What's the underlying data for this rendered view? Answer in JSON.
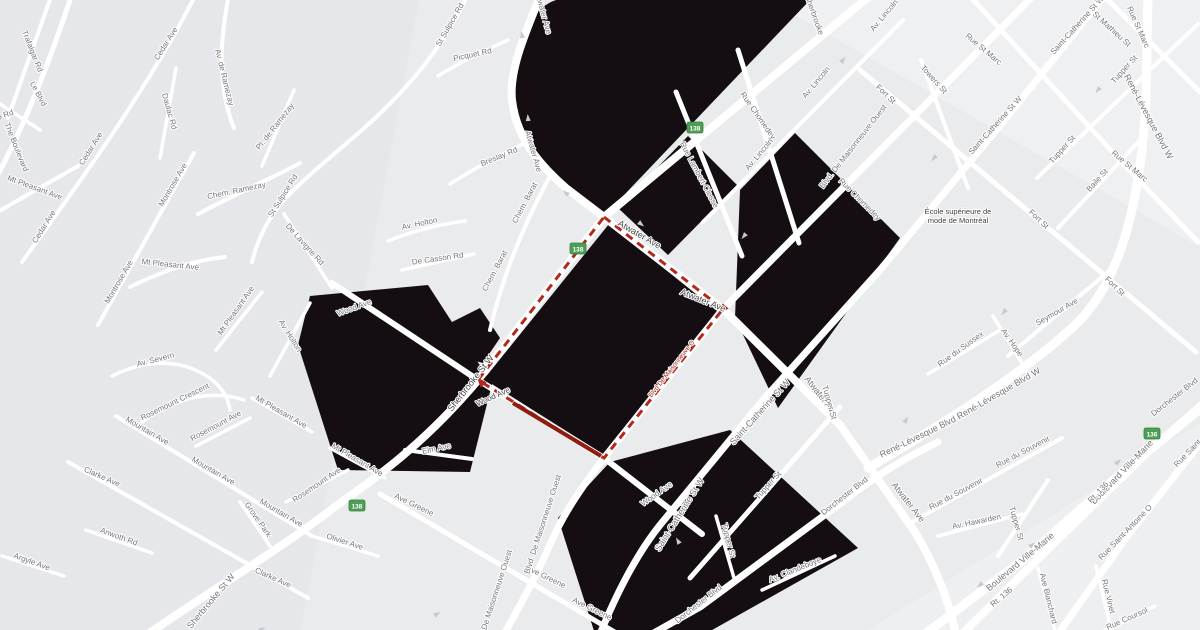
{
  "map": {
    "colors": {
      "background": "#eaebed",
      "tint_west": "#e2e3e7",
      "tint_light": "#f2f3f5",
      "street": "#ffffff",
      "black_area": "#140d12",
      "route_dash": "#b5271b",
      "route_solid": "#8f1b12",
      "shield_fill": "#4d9f55",
      "shield_border": "#3c7f43",
      "label": "#75767a",
      "label_dark": "#46474a",
      "arrow": "#c7c9ce"
    },
    "black_polygons": [
      "M556,0 L810,0 L604,216 C578,197 556,183 541,167 C519,144 511,114 512,84 C513,40 532,8 556,0 Z",
      "M618,208 L688,136 L737,185 L668,255 Z",
      "M740,190 L795,133 L900,238 L778,408 L735,318 Z",
      "M609,224 L717,311 L604,455 L484,379 Z",
      "M452,322 L480,308 L500,338 L483,363 L456,356 Z",
      "M310,296 L428,285 L492,384 L470,472 L338,470 L298,345 Z",
      "M610,462 L730,430 L858,548 L705,634 L595,634 L558,518 Z"
    ],
    "streets": [
      {
        "d": "M541,-6 C523,38 509,72 512,100 C516,134 534,160 566,188 L604,217 L723,309 L840,425 L915,532 C935,565 948,598 956,634",
        "w": 8
      },
      {
        "d": "M872,-6 L604,217 L478,380 C430,437 385,472 340,503 C282,548 230,578 148,634",
        "w": 8
      },
      {
        "d": "M1035,-6 L723,309 L604,458 C578,492 561,518 549,547 C535,578 520,606 504,634",
        "w": 7
      },
      {
        "d": "M1106,-6 L998,128 L880,270 L763,400 L660,525 C640,550 620,585 600,634",
        "w": 7
      },
      {
        "d": "M332,283 L478,380 L604,458 L702,534",
        "w": 6
      },
      {
        "d": "M868,468 C950,420 1020,375 1072,328 C1118,287 1140,210 1146,100 L1148,-6",
        "w": 9
      },
      {
        "d": "M652,634 L700,607 L845,500 C880,473 905,458 938,442",
        "w": 7
      },
      {
        "d": "M925,634 L1023,560 L1125,470 L1205,405",
        "w": 9
      },
      {
        "d": "M962,634 L1052,545 L1148,452 L1205,402",
        "w": 8
      },
      {
        "d": "M1198,446 L1128,535 L1058,634",
        "w": 7
      },
      {
        "d": "M968,-6 L1128,169 L1198,242",
        "w": 5
      },
      {
        "d": "M860,70 L1196,352",
        "w": 5
      },
      {
        "d": "M1102,-6 L1200,92",
        "w": 5
      },
      {
        "d": "M921,60 L968,188",
        "w": 4
      },
      {
        "d": "M676,92 L742,256",
        "w": 5
      },
      {
        "d": "M738,50 L799,243",
        "w": 5
      },
      {
        "d": "M703,222 L903,20",
        "w": 4
      },
      {
        "d": "M1037,178 L1198,24",
        "w": 4
      },
      {
        "d": "M1058,228 L1143,137",
        "w": 4
      },
      {
        "d": "M690,578 L840,407",
        "w": 5
      },
      {
        "d": "M998,556 L1048,480",
        "w": 4
      },
      {
        "d": "M1008,356 L1108,272",
        "w": 4
      },
      {
        "d": "M993,316 L1031,378",
        "w": 3.5
      },
      {
        "d": "M928,374 L1000,330",
        "w": 3.5
      },
      {
        "d": "M912,522 L1062,438",
        "w": 4
      },
      {
        "d": "M938,536 L1022,514",
        "w": 3.5
      },
      {
        "d": "M762,590 L835,556",
        "w": 3.5
      },
      {
        "d": "M1096,566 L1112,634",
        "w": 3.5
      },
      {
        "d": "M1038,568 L1056,634",
        "w": 3.5
      },
      {
        "d": "M1098,634 L1155,606",
        "w": 3.5
      },
      {
        "d": "M716,516 L734,578",
        "w": 3.5
      },
      {
        "d": "M380,494 L618,634",
        "w": 5
      },
      {
        "d": "M405,450 L472,459",
        "w": 4
      },
      {
        "d": "M72,-6 C45,75 22,130 -6,182",
        "w": 5
      },
      {
        "d": "M52,-6 L8,118",
        "w": 4
      },
      {
        "d": "M196,-6 C150,85 85,175 22,262",
        "w": 4
      },
      {
        "d": "M229,-6 C219,45 218,88 234,128",
        "w": 4
      },
      {
        "d": "M198,214 C240,192 272,178 300,163",
        "w": 4
      },
      {
        "d": "M262,166 L294,90",
        "w": 3.5
      },
      {
        "d": "M176,68 L160,158",
        "w": 3.5
      },
      {
        "d": "M468,-6 C442,50 405,92 362,130 C330,158 302,180 284,200 C268,218 258,238 252,262",
        "w": 4
      },
      {
        "d": "M284,214 L332,288",
        "w": 3.5
      },
      {
        "d": "M508,40 C482,52 460,62 438,76",
        "w": 3.5
      },
      {
        "d": "M532,140 C505,152 478,166 450,184",
        "w": 3.5
      },
      {
        "d": "M549,178 C522,228 502,278 490,330",
        "w": 4
      },
      {
        "d": "M388,241 C415,230 442,224 465,221",
        "w": 3.5
      },
      {
        "d": "M270,376 L310,303",
        "w": 3.5
      },
      {
        "d": "M402,270 L474,254",
        "w": 3.5
      },
      {
        "d": "M112,376 C148,358 180,360 205,375 C220,384 228,396 230,410",
        "w": 3.5
      },
      {
        "d": "M194,153 L98,325",
        "w": 4
      },
      {
        "d": "M-6,214 L78,166",
        "w": 4
      },
      {
        "d": "M130,287 C165,270 195,260 225,257",
        "w": 4
      },
      {
        "d": "M216,350 L262,292",
        "w": 3.5
      },
      {
        "d": "M252,398 L312,432",
        "w": 3.5
      },
      {
        "d": "M330,448 L385,478",
        "w": 3.5
      },
      {
        "d": "M142,422 C178,396 212,390 244,400",
        "w": 3.5
      },
      {
        "d": "M196,446 L250,418",
        "w": 3.5
      },
      {
        "d": "M286,502 L348,470",
        "w": 3.5
      },
      {
        "d": "M116,416 L312,536",
        "w": 4
      },
      {
        "d": "M68,462 L308,598",
        "w": 4
      },
      {
        "d": "M86,530 L152,553",
        "w": 3.5
      },
      {
        "d": "M2,556 L64,576",
        "w": 3.5
      },
      {
        "d": "M240,502 L270,546",
        "w": 3.5
      },
      {
        "d": "M312,536 L378,556",
        "w": 3.5
      },
      {
        "d": "M-6,100 L40,130",
        "w": 3.5
      }
    ],
    "route": {
      "loop_points": "604,217 723,309 604,458 478,380 604,217",
      "solid_segment": "M513,403 L601,456",
      "arrowheads": [
        {
          "x": 723,
          "y": 309,
          "rot": 130
        },
        {
          "x": 481,
          "y": 382,
          "rot": 228
        }
      ],
      "street_label": {
        "text": "Blvd De Maisonneuve O",
        "x": 673,
        "y": 370,
        "angle": -52
      }
    },
    "shields": [
      {
        "label": "138",
        "x": 695,
        "y": 128
      },
      {
        "label": "138",
        "x": 578,
        "y": 249
      },
      {
        "label": "138",
        "x": 357,
        "y": 506
      },
      {
        "label": "136",
        "x": 1152,
        "y": 434
      }
    ],
    "poi": {
      "lines": [
        "École supérieure de",
        "mode de Montréal"
      ],
      "x": 958,
      "y": 214
    },
    "street_labels": [
      {
        "t": "Trafalgar Rd",
        "x": 30,
        "y": 52,
        "a": 68
      },
      {
        "t": "Le Blvd",
        "x": 36,
        "y": 95,
        "a": 62
      },
      {
        "t": "The Boulevard",
        "x": 14,
        "y": 148,
        "a": 68
      },
      {
        "t": "eo Rd",
        "x": 4,
        "y": 118,
        "a": -20
      },
      {
        "t": "Cedar Ave",
        "x": 168,
        "y": 45,
        "a": -58
      },
      {
        "t": "Cedar Ave",
        "x": 93,
        "y": 150,
        "a": -58
      },
      {
        "t": "Cedar Ave",
        "x": 46,
        "y": 228,
        "a": -58
      },
      {
        "t": "Av. de Ramezay",
        "x": 222,
        "y": 78,
        "a": 76
      },
      {
        "t": "Daulac Rd",
        "x": 167,
        "y": 112,
        "a": 74
      },
      {
        "t": "Pl. de Ramezay",
        "x": 277,
        "y": 128,
        "a": -52
      },
      {
        "t": "Chem. Ramezay",
        "x": 237,
        "y": 193,
        "a": -12
      },
      {
        "t": "St Sulpice Rd",
        "x": 452,
        "y": 26,
        "a": -60
      },
      {
        "t": "St Sulpice Rd",
        "x": 285,
        "y": 197,
        "a": -58
      },
      {
        "t": "Montrose Ave",
        "x": 175,
        "y": 186,
        "a": -60
      },
      {
        "t": "Montrose Ave",
        "x": 121,
        "y": 283,
        "a": -60
      },
      {
        "t": "Mt Pleasant Ave",
        "x": 34,
        "y": 190,
        "a": 20
      },
      {
        "t": "Mt Pleasant Ave",
        "x": 170,
        "y": 267,
        "a": 6
      },
      {
        "t": "Mt Pleasant Ave",
        "x": 238,
        "y": 312,
        "a": -55
      },
      {
        "t": "Mt Pleasant Ave",
        "x": 280,
        "y": 414,
        "a": 30
      },
      {
        "t": "Mt Pleasant Ave",
        "x": 356,
        "y": 462,
        "a": 30
      },
      {
        "t": "De Lavigne Rd",
        "x": 303,
        "y": 246,
        "a": 48
      },
      {
        "t": "Av. Holton",
        "x": 420,
        "y": 226,
        "a": -12
      },
      {
        "t": "Av. Holton",
        "x": 288,
        "y": 337,
        "a": 58
      },
      {
        "t": "De Casson Rd",
        "x": 438,
        "y": 261,
        "a": -8
      },
      {
        "t": "Av. Severn",
        "x": 156,
        "y": 362,
        "a": -14
      },
      {
        "t": "Wood Ave",
        "x": 355,
        "y": 310,
        "a": -20
      },
      {
        "t": "Rosemount Crescent",
        "x": 176,
        "y": 404,
        "a": -26
      },
      {
        "t": "Rosemount Ave",
        "x": 217,
        "y": 428,
        "a": -28
      },
      {
        "t": "Rosemount Ave",
        "x": 318,
        "y": 487,
        "a": -34
      },
      {
        "t": "Mountain Ave",
        "x": 146,
        "y": 433,
        "a": 30
      },
      {
        "t": "Mountain Ave",
        "x": 212,
        "y": 473,
        "a": 30
      },
      {
        "t": "Mountain Ave",
        "x": 280,
        "y": 515,
        "a": 30
      },
      {
        "t": "Clarke Ave",
        "x": 101,
        "y": 479,
        "a": 24
      },
      {
        "t": "Clarke Ave",
        "x": 272,
        "y": 580,
        "a": 24
      },
      {
        "t": "Anwoth Rd",
        "x": 118,
        "y": 539,
        "a": 20
      },
      {
        "t": "Argyle Ave",
        "x": 31,
        "y": 564,
        "a": 20
      },
      {
        "t": "Grove Park",
        "x": 256,
        "y": 521,
        "a": 55
      },
      {
        "t": "Olivier Ave",
        "x": 344,
        "y": 544,
        "a": 18
      },
      {
        "t": "Sherbrooke St W",
        "x": 213,
        "y": 603,
        "a": -50,
        "s": 9
      },
      {
        "t": "Elm Ave",
        "x": 437,
        "y": 451,
        "a": -12
      },
      {
        "t": "Ave Greene",
        "x": 413,
        "y": 507,
        "a": 26
      },
      {
        "t": "Ave Greene",
        "x": 545,
        "y": 579,
        "a": 26
      },
      {
        "t": "Ave Greene",
        "x": 591,
        "y": 611,
        "a": 26
      },
      {
        "t": "Picquet Rd",
        "x": 473,
        "y": 57,
        "a": -12
      },
      {
        "t": "Atwater Ave",
        "x": 541,
        "y": 14,
        "a": 75
      },
      {
        "t": "Atwater Ave",
        "x": 531,
        "y": 152,
        "a": 74
      },
      {
        "t": "Breslay Rd",
        "x": 500,
        "y": 159,
        "a": -22
      },
      {
        "t": "Chem. Barat",
        "x": 527,
        "y": 204,
        "a": -62
      },
      {
        "t": "Chem. Barat",
        "x": 497,
        "y": 272,
        "a": -62
      },
      {
        "t": "Atwater Ave",
        "x": 638,
        "y": 237,
        "a": 30,
        "c": "dark",
        "s": 9
      },
      {
        "t": "Atwater Ave",
        "x": 702,
        "y": 303,
        "a": 22,
        "c": "dark",
        "s": 9
      },
      {
        "t": "Atwater Ave",
        "x": 819,
        "y": 398,
        "a": 52,
        "s": 9
      },
      {
        "t": "Atwater Ave",
        "x": 906,
        "y": 504,
        "a": 52,
        "s": 9
      },
      {
        "t": "Sherbrooke St W",
        "x": 473,
        "y": 385,
        "a": -52,
        "c": "dark",
        "s": 9
      },
      {
        "t": "Wood Ave",
        "x": 494,
        "y": 399,
        "a": -24,
        "c": "dark"
      },
      {
        "t": "Blvd. De Maisonneuve Ouest",
        "x": 545,
        "y": 525,
        "a": -72
      },
      {
        "t": "Blvd. De Maisonneuve Ouest",
        "x": 496,
        "y": 600,
        "a": -72
      },
      {
        "t": "Saint-Catherine St W",
        "x": 762,
        "y": 414,
        "a": -48,
        "s": 9
      },
      {
        "t": "Saint-Catherine St W",
        "x": 682,
        "y": 516,
        "a": -58,
        "s": 9
      },
      {
        "t": "Wood Ave",
        "x": 658,
        "y": 496,
        "a": -35
      },
      {
        "t": "Tupper St",
        "x": 770,
        "y": 487,
        "a": -48
      },
      {
        "t": "Tupper St",
        "x": 726,
        "y": 541,
        "a": 76
      },
      {
        "t": "Tupper St",
        "x": 827,
        "y": 403,
        "a": 74
      },
      {
        "t": "Tupper St",
        "x": 1014,
        "y": 524,
        "a": 74
      },
      {
        "t": "Dorchester Blvd",
        "x": 700,
        "y": 606,
        "a": -38
      },
      {
        "t": "Dorchester Blvd",
        "x": 846,
        "y": 498,
        "a": -38
      },
      {
        "t": "Dorchester Blvd",
        "x": 1176,
        "y": 399,
        "a": -38
      },
      {
        "t": "Av. Clandeboye",
        "x": 796,
        "y": 572,
        "a": -22
      },
      {
        "t": "Sherbrooke",
        "x": 812,
        "y": 16,
        "a": 70
      },
      {
        "t": "Rue Lambert-Closse",
        "x": 697,
        "y": 176,
        "a": 62
      },
      {
        "t": "Rue Chomedey",
        "x": 756,
        "y": 117,
        "a": 55
      },
      {
        "t": "Rue Chomedey",
        "x": 858,
        "y": 201,
        "a": 45
      },
      {
        "t": "Av. Lincoln",
        "x": 761,
        "y": 156,
        "a": -50
      },
      {
        "t": "Av. Lincoln",
        "x": 818,
        "y": 84,
        "a": -50
      },
      {
        "t": "Av. Lincoln",
        "x": 886,
        "y": 17,
        "a": -50
      },
      {
        "t": "Blvd. De Maisonneuve Ouest",
        "x": 855,
        "y": 148,
        "a": -52
      },
      {
        "t": "Towers St",
        "x": 932,
        "y": 81,
        "a": 48
      },
      {
        "t": "Fort St",
        "x": 884,
        "y": 96,
        "a": 44
      },
      {
        "t": "Fort St",
        "x": 1037,
        "y": 221,
        "a": 44
      },
      {
        "t": "Fort St",
        "x": 1113,
        "y": 288,
        "a": 44
      },
      {
        "t": "Rue St Marc",
        "x": 982,
        "y": 51,
        "a": 40
      },
      {
        "t": "Rue St Marc",
        "x": 1128,
        "y": 168,
        "a": 40
      },
      {
        "t": "Rue St Marc",
        "x": 1136,
        "y": 28,
        "a": 66
      },
      {
        "t": "St Mathieu St",
        "x": 1110,
        "y": 31,
        "a": 42
      },
      {
        "t": "Saint-Catherine St W",
        "x": 1079,
        "y": 27,
        "a": -48
      },
      {
        "t": "Saint-Catherine St W",
        "x": 997,
        "y": 127,
        "a": -48
      },
      {
        "t": "Tupper St",
        "x": 1126,
        "y": 71,
        "a": -48
      },
      {
        "t": "Tupper St",
        "x": 1064,
        "y": 151,
        "a": -48
      },
      {
        "t": "Baile St",
        "x": 1099,
        "y": 182,
        "a": -48
      },
      {
        "t": "René-Lévesque Blvd W",
        "x": 1146,
        "y": 118,
        "a": 62,
        "s": 9
      },
      {
        "t": "René-Lévesque Blvd W",
        "x": 924,
        "y": 437,
        "a": -26,
        "s": 9
      },
      {
        "t": "René-Lévesque Blvd W",
        "x": 1000,
        "y": 396,
        "a": -30,
        "s": 9
      },
      {
        "t": "Rue du Sussex",
        "x": 962,
        "y": 351,
        "a": -36
      },
      {
        "t": "Seymour Ave",
        "x": 1058,
        "y": 314,
        "a": -30
      },
      {
        "t": "Av. Hope",
        "x": 1010,
        "y": 344,
        "a": 55
      },
      {
        "t": "Rue du Souvenir",
        "x": 957,
        "y": 496,
        "a": -28
      },
      {
        "t": "Rue du Souvenir",
        "x": 1024,
        "y": 454,
        "a": -28
      },
      {
        "t": "Av. Hawarden",
        "x": 977,
        "y": 524,
        "a": -12
      },
      {
        "t": "Boulevard Ville-Marie",
        "x": 1022,
        "y": 564,
        "a": -40,
        "s": 9
      },
      {
        "t": "Boulevard Ville-Marie",
        "x": 1124,
        "y": 474,
        "a": -46,
        "s": 9
      },
      {
        "t": "Rt. 136",
        "x": 1003,
        "y": 599,
        "a": -40
      },
      {
        "t": "Rt. 136",
        "x": 1100,
        "y": 494,
        "a": -46
      },
      {
        "t": "Rue Saint-Antoine O",
        "x": 1127,
        "y": 534,
        "a": -46
      },
      {
        "t": "Rue Saint-A",
        "x": 1192,
        "y": 452,
        "a": -46
      },
      {
        "t": "Rue Vinet",
        "x": 1106,
        "y": 597,
        "a": 76
      },
      {
        "t": "Ave Blanchard",
        "x": 1046,
        "y": 599,
        "a": 76
      },
      {
        "t": "Rue Coursol",
        "x": 1128,
        "y": 621,
        "a": -24
      }
    ],
    "traffic_arrows": [
      {
        "x": 522,
        "y": 35,
        "r": -100
      },
      {
        "x": 528,
        "y": 118,
        "r": -95
      },
      {
        "x": 641,
        "y": 224,
        "r": 38
      },
      {
        "x": 566,
        "y": 193,
        "r": 220
      },
      {
        "x": 843,
        "y": 60,
        "r": -48
      },
      {
        "x": 744,
        "y": 236,
        "r": 130
      },
      {
        "x": 934,
        "y": 158,
        "r": 130
      },
      {
        "x": 906,
        "y": 420,
        "r": -60
      },
      {
        "x": 1098,
        "y": 90,
        "r": 130
      },
      {
        "x": 437,
        "y": 614,
        "r": -28
      },
      {
        "x": 678,
        "y": 541,
        "r": -120
      },
      {
        "x": 1032,
        "y": 545,
        "r": -40
      },
      {
        "x": 1118,
        "y": 462,
        "r": -40
      },
      {
        "x": 980,
        "y": 585,
        "r": 140
      },
      {
        "x": 1004,
        "y": 312,
        "r": 130
      },
      {
        "x": 262,
        "y": 629,
        "r": -30
      }
    ]
  }
}
